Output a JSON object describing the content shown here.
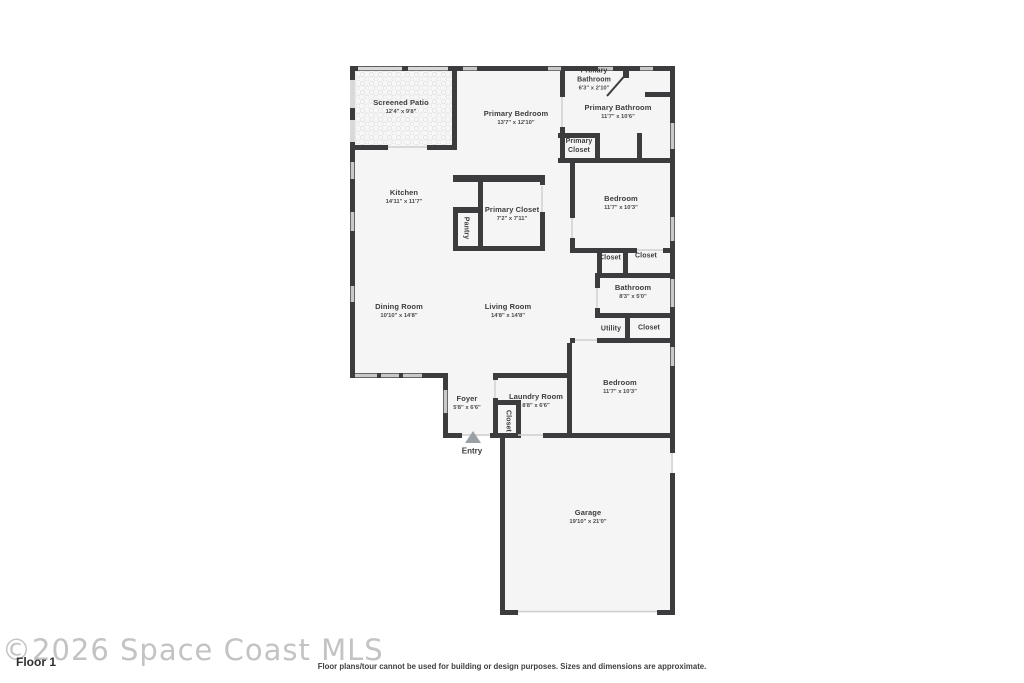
{
  "floorplan": {
    "watermark": "©2026 Space Coast MLS",
    "floor_label": "Floor 1",
    "disclaimer": "Floor plans/tour cannot be used for building or design purposes. Sizes and dimensions are approximate.",
    "entry_label": "Entry"
  },
  "rooms": [
    {
      "name": "Screened Patio",
      "dims": "12'4\" x 9'8\""
    },
    {
      "name": "Primary Bedroom",
      "dims": "13'7\" x 12'10\""
    },
    {
      "name": "Primary Bathroom",
      "dims": "6'3\" x 2'10\""
    },
    {
      "name": "Primary Bathroom",
      "dims": "11'7\" x 10'6\""
    },
    {
      "name": "Primary Closet",
      "dims": ""
    },
    {
      "name": "Kitchen",
      "dims": "14'11\" x 11'7\""
    },
    {
      "name": "Primary Closet",
      "dims": "7'2\" x 7'11\""
    },
    {
      "name": "Pantry",
      "dims": ""
    },
    {
      "name": "Bedroom",
      "dims": "11'7\" x 10'3\""
    },
    {
      "name": "Closet",
      "dims": ""
    },
    {
      "name": "Closet",
      "dims": ""
    },
    {
      "name": "Bathroom",
      "dims": "8'3\" x 5'0\""
    },
    {
      "name": "Utility",
      "dims": ""
    },
    {
      "name": "Closet",
      "dims": ""
    },
    {
      "name": "Dining Room",
      "dims": "10'10\" x 14'8\""
    },
    {
      "name": "Living Room",
      "dims": "14'8\" x 14'8\""
    },
    {
      "name": "Foyer",
      "dims": "5'8\" x 6'6\""
    },
    {
      "name": "Laundry Room",
      "dims": "8'8\" x 6'6\""
    },
    {
      "name": "Closet",
      "dims": ""
    },
    {
      "name": "Bedroom",
      "dims": "11'7\" x 10'3\""
    },
    {
      "name": "Garage",
      "dims": "19'10\" x 21'0\""
    }
  ],
  "colors": {
    "wall": "#3c3c3e",
    "floor": "#f5f5f5",
    "window": "#c9c9c9",
    "screen": "#d9d9d9",
    "text": "#3d3d3d"
  }
}
